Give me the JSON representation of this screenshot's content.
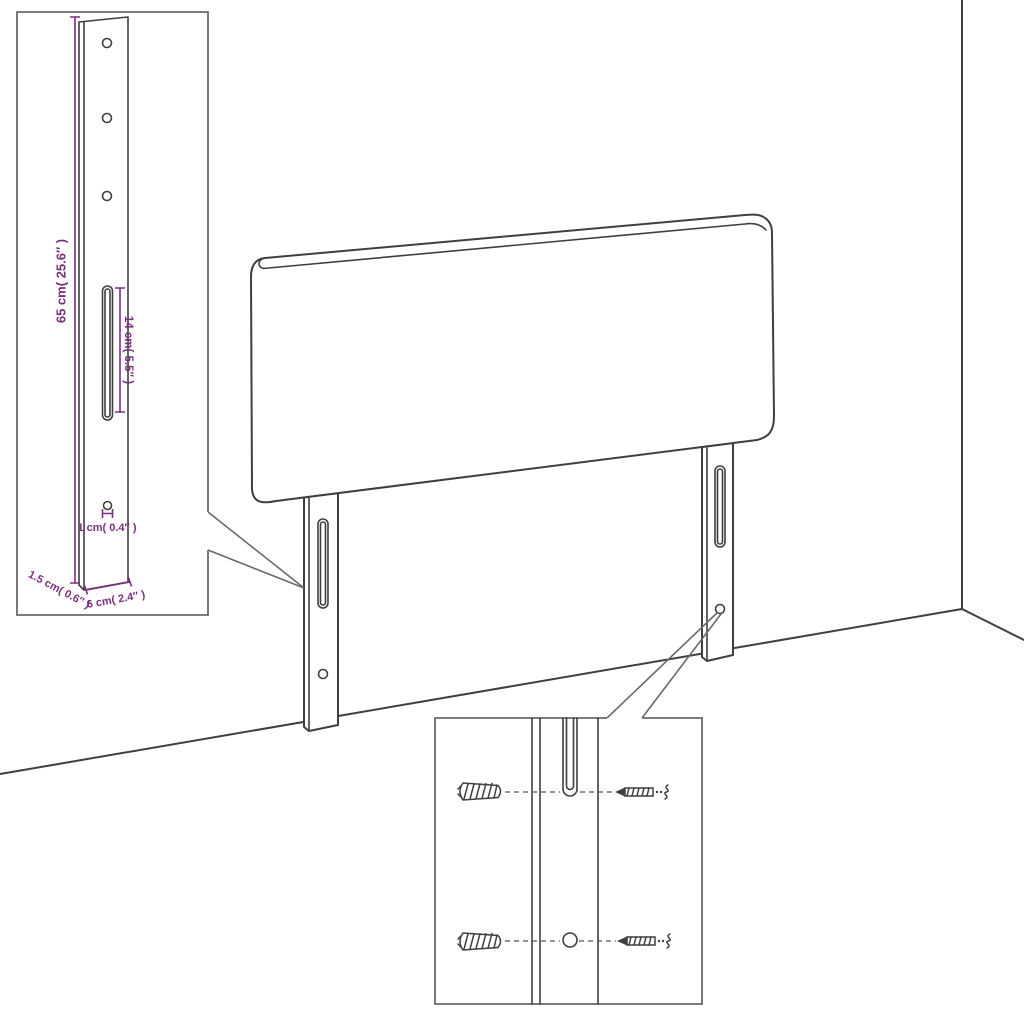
{
  "diagram": {
    "subject": "headboard-with-mounting-legs-assembly-diagram",
    "colors": {
      "background": "#ffffff",
      "line": "#3f3f3f",
      "inset_border": "#6a6a6a",
      "dimension": "#7b2e80"
    },
    "bracket_inset": {
      "height_label": "65 cm( 25.6″ )",
      "slot_label": "14 cm( 5.5″ )",
      "hole_label": "1 cm( 0.4″ )",
      "thickness_label": "1.5 cm( 0.6″ )",
      "width_label": "6 cm( 2.4″ )"
    },
    "hardware_inset": {
      "icons": {
        "left_fasteners": "wall-plug-icon",
        "right_fasteners": "screw-icon"
      }
    }
  }
}
